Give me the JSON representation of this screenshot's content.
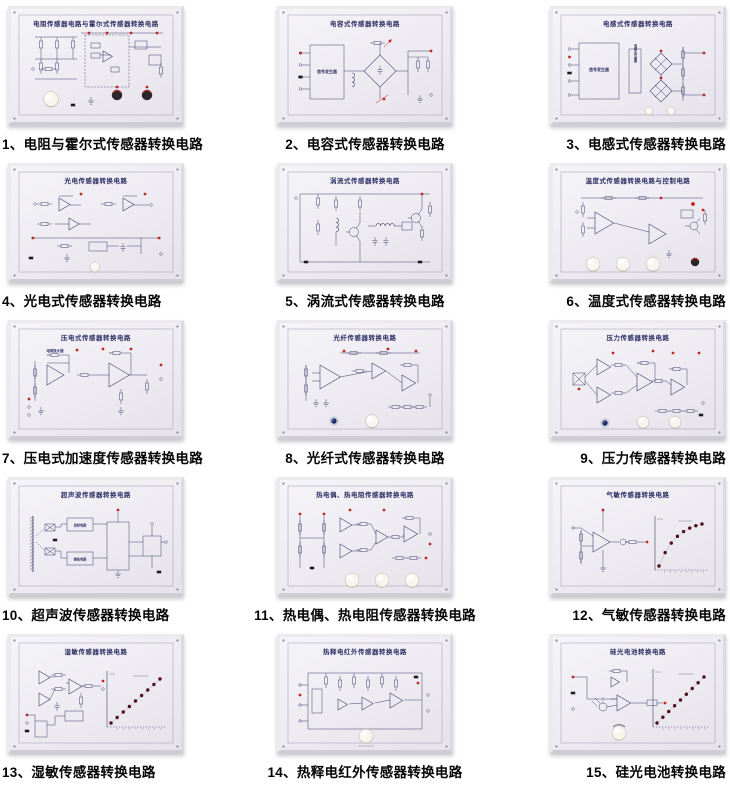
{
  "page": {
    "background": "#ffffff",
    "description": "catalog sheet of 15 sensor conversion circuit training boards"
  },
  "colors": {
    "line": "#3e4070",
    "title": "#2b2d63",
    "red": "#c22525",
    "dot_dark": "#511018",
    "led_blue": "#1b2a6e",
    "caption": "#050505",
    "panel_face": "#edebf1",
    "frame": "#eceaee"
  },
  "panels": [
    {
      "id": 1,
      "caption": "1、电阻与霍尔式传感器转换电路",
      "board_title": "电阻传感器电路与霍尔式传感器转换电路",
      "kind": "hall",
      "features": {
        "white_knobs": 1,
        "dark_knobs": 2,
        "led": false,
        "graph": "none"
      }
    },
    {
      "id": 2,
      "caption": "2、电容式传感器转换电路",
      "board_title": "电容式传感器转换电路",
      "kind": "cap",
      "labels": {
        "box": "信号发生器"
      },
      "features": {
        "white_knobs": 0,
        "dark_knobs": 0,
        "led": false,
        "graph": "none"
      }
    },
    {
      "id": 3,
      "caption": "3、电感式传感器转换电路",
      "board_title": "电感式传感器转换电路",
      "kind": "ind",
      "labels": {
        "box": "信号发生器",
        "sensor": "电感式传感器"
      },
      "features": {
        "white_knobs": 2,
        "dark_knobs": 0,
        "led": false,
        "graph": "none"
      }
    },
    {
      "id": 4,
      "caption": "4、光电式传感器转换电路",
      "board_title": "光电传感器转换电路",
      "kind": "quad",
      "features": {
        "white_knobs": 1,
        "dark_knobs": 0,
        "led": false,
        "graph": "none"
      }
    },
    {
      "id": 5,
      "caption": "5、涡流式传感器转换电路",
      "board_title": "涡流式传感器转换电路",
      "kind": "eddy",
      "features": {
        "white_knobs": 0,
        "dark_knobs": 0,
        "led": false,
        "graph": "none"
      }
    },
    {
      "id": 6,
      "caption": "6、温度式传感器转换电路",
      "board_title": "温度式传感器转换电路与控制电路",
      "kind": "temp",
      "features": {
        "white_knobs": 3,
        "dark_knobs": 1,
        "led": false,
        "graph": "none"
      }
    },
    {
      "id": 7,
      "caption": "7、压电式加速度传感器转换电路",
      "board_title": "压电式传感器转换电路",
      "kind": "piezo",
      "labels": {
        "section": "电荷放大器"
      },
      "features": {
        "white_knobs": 0,
        "dark_knobs": 0,
        "led": false,
        "graph": "none"
      }
    },
    {
      "id": 8,
      "caption": "8、光纤式传感器转换电路",
      "board_title": "光纤传感器转换电路",
      "kind": "fiber",
      "features": {
        "white_knobs": 1,
        "dark_knobs": 0,
        "led": true,
        "graph": "none"
      }
    },
    {
      "id": 9,
      "caption": "9、压力传感器转换电路",
      "board_title": "压力传感器转换电路",
      "kind": "pressure",
      "features": {
        "white_knobs": 2,
        "dark_knobs": 0,
        "led": true,
        "graph": "none"
      }
    },
    {
      "id": 10,
      "caption": "10、超声波传感器转换电路",
      "board_title": "超声波传感器转换电路",
      "kind": "ultra",
      "labels": {
        "tx": "发射电路",
        "rx": "接收电路"
      },
      "features": {
        "white_knobs": 0,
        "dark_knobs": 0,
        "led": false,
        "graph": "none"
      }
    },
    {
      "id": 11,
      "caption": "11、热电偶、热电阻传感器转换电路",
      "board_title": "热电偶、热电阻传感器转换电路",
      "kind": "thermo",
      "features": {
        "white_knobs": 3,
        "dark_knobs": 0,
        "led": false,
        "graph": "none"
      }
    },
    {
      "id": 12,
      "caption": "12、气敏传感器转换电路",
      "board_title": "气敏传感器转换电路",
      "kind": "gas",
      "features": {
        "white_knobs": 0,
        "dark_knobs": 0,
        "led": false,
        "graph": "saturating"
      }
    },
    {
      "id": 13,
      "caption": "13、湿敏传感器转换电路",
      "board_title": "湿敏传感器转换电路",
      "kind": "humid",
      "features": {
        "white_knobs": 0,
        "dark_knobs": 0,
        "led": false,
        "graph": "linear"
      }
    },
    {
      "id": 14,
      "caption": "14、热释电红外传感器转换电路",
      "board_title": "热释电红外传感器转换电路",
      "kind": "pyro",
      "features": {
        "white_knobs": 1,
        "dark_knobs": 0,
        "led": false,
        "graph": "none"
      }
    },
    {
      "id": 15,
      "caption": "15、硅光电池转换电路",
      "board_title": "硅光电池转换电路",
      "kind": "silicon",
      "features": {
        "white_knobs": 1,
        "dark_knobs": 0,
        "led": false,
        "graph": "linear"
      }
    }
  ]
}
